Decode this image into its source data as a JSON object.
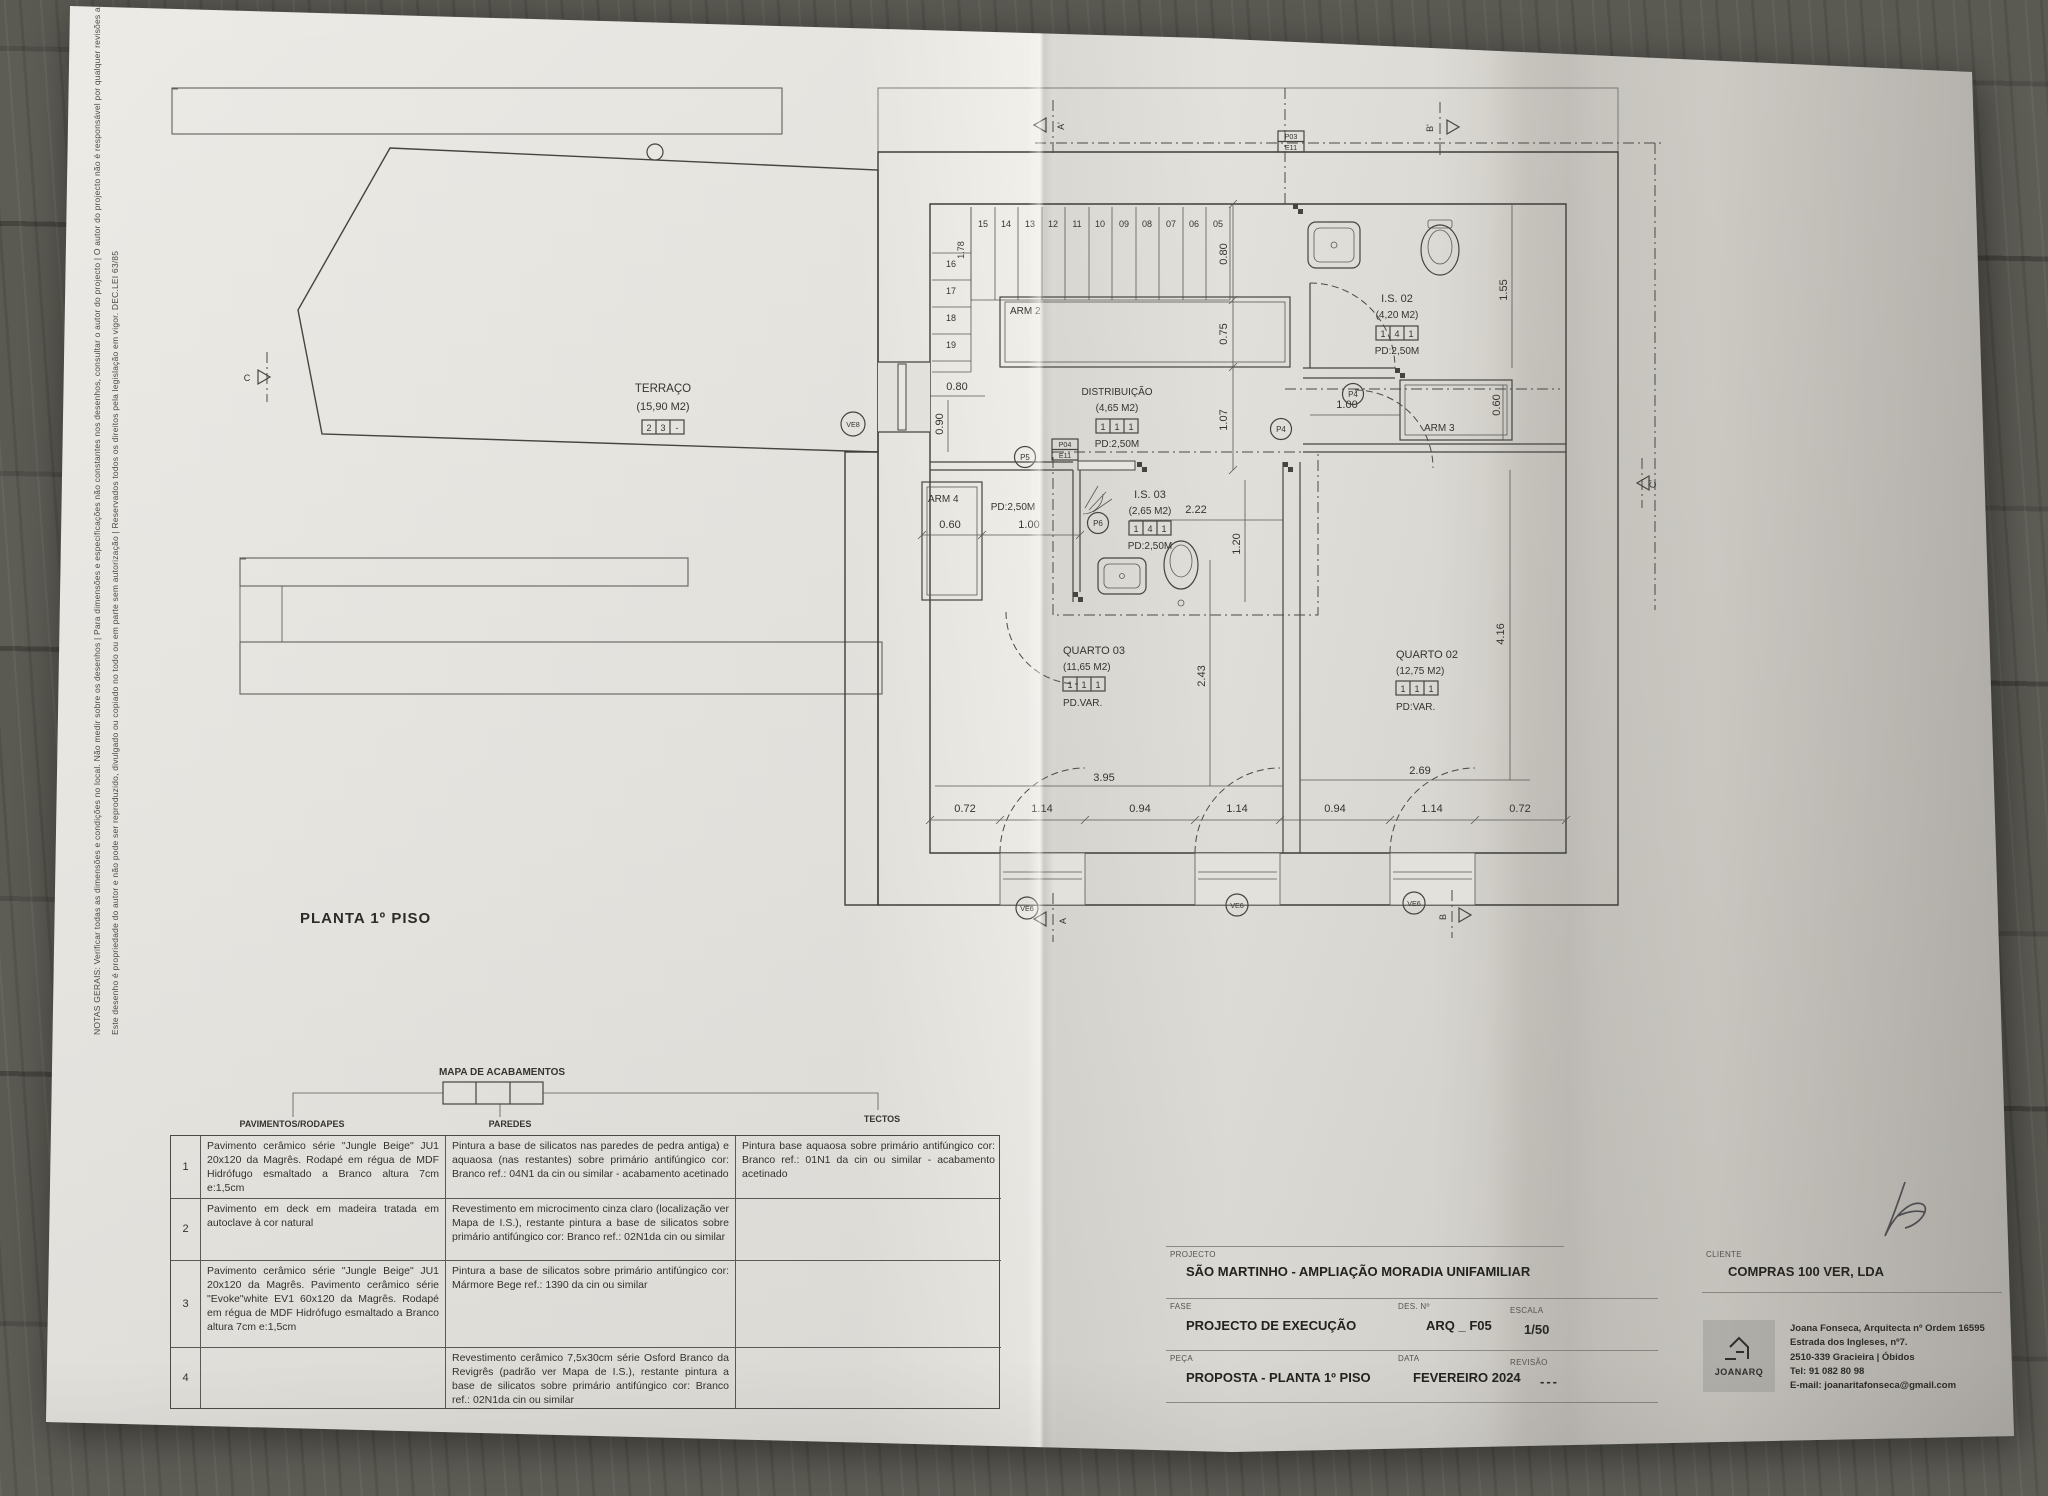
{
  "notes": {
    "line1": "NOTAS GERAIS: Verificar todas as dimensões e condições no local. Não medir sobre os desenhos | Para dimensões e especificações não constantes nos desenhos, consultar o autor do projecto | O autor do projecto não é responsável por qualquer revisões ao projecto original.",
    "line2": "Este desenho é propriedade do autor e não pode ser reproduzido, divulgado ou copiado no todo ou em parte sem autorização | Reservados todos os direitos pela legislação em vigor. DEC.LEI 63/85"
  },
  "plan": {
    "title": "PLANTA 1º PISO",
    "rooms": {
      "terraco": {
        "name": "TERRAÇO",
        "area": "(15,90 M2)",
        "finish": [
          "2",
          "3",
          "-"
        ]
      },
      "distribuicao": {
        "name": "DISTRIBUIÇÃO",
        "area": "(4,65 M2)",
        "finish": [
          "1",
          "1",
          "1"
        ],
        "pd": "PD:2,50M"
      },
      "is02": {
        "name": "I.S. 02",
        "area": "(4,20 M2)",
        "finish": [
          "1",
          "4",
          "1"
        ],
        "pd": "PD:2,50M"
      },
      "is03": {
        "name": "I.S. 03",
        "area": "(2,65 M2)",
        "finish": [
          "1",
          "4",
          "1"
        ],
        "pd": "PD:2,50M"
      },
      "quarto03": {
        "name": "QUARTO 03",
        "area": "(11,65 M2)",
        "finish": [
          "1",
          "1",
          "1"
        ],
        "pd": "PD.VAR."
      },
      "quarto02": {
        "name": "QUARTO 02",
        "area": "(12,75 M2)",
        "finish": [
          "1",
          "1",
          "1"
        ],
        "pd": "PD:VAR."
      }
    },
    "closets": {
      "arm2": "ARM 2",
      "arm3": "ARM 3",
      "arm4": "ARM 4"
    },
    "corridor_pd": "PD:2,50M",
    "stairs": {
      "top": [
        "15",
        "14",
        "13",
        "12",
        "11",
        "10",
        "09",
        "08",
        "07",
        "06",
        "05"
      ],
      "left": [
        "16",
        "17",
        "18",
        "19"
      ],
      "height": "1.78"
    },
    "dims": {
      "stair_run": "0.80",
      "arm2_depth": "0.75",
      "corridor_width": "1.07",
      "terrace_door_w": "0.80",
      "terrace_door_h": "0.90",
      "is02_door": "1.00",
      "is02_depth": "1.55",
      "arm3_depth": "0.60",
      "is03_length": "2.22",
      "is03_width": "1.20",
      "arm4_width": "0.60",
      "arm4_offset": "1.00",
      "q03_width": "2.43",
      "q03_length": "3.95",
      "q02_length": "2.69",
      "q02_height": "4.16",
      "bottom": [
        "0.72",
        "1.14",
        "0.94",
        "1.14",
        "0.94",
        "1.14",
        "0.72"
      ]
    },
    "tags": {
      "ve8": "VE8",
      "ve6": "VE6",
      "p4": "P4",
      "p5": "P5",
      "p6": "P6",
      "p04": "P04",
      "e11": "E11",
      "p03": "P03"
    },
    "markers": {
      "a_top": "A'",
      "b_top": "B'",
      "a_bottom": "A",
      "b_bottom": "B",
      "c_left": "C",
      "c_right": "C'"
    }
  },
  "finish_map": {
    "title": "MAPA DE ACABAMENTOS",
    "columns": [
      "PAVIMENTOS/RODAPES",
      "PAREDES",
      "TECTOS"
    ],
    "rows": [
      {
        "num": "1",
        "pavimentos": "Pavimento cerâmico série \"Jungle Beige\" JU1 20x120 da Magrês. Rodapé em régua de MDF Hidrófugo esmaltado a Branco altura 7cm e:1,5cm",
        "paredes": "Pintura a base de silicatos nas paredes de pedra antiga) e aquaosa (nas restantes) sobre primário antifúngico cor: Branco ref.: 04N1 da cin ou similar - acabamento acetinado",
        "tectos": "Pintura base aquaosa sobre primário antifúngico cor: Branco ref.: 01N1 da cin ou similar - acabamento acetinado"
      },
      {
        "num": "2",
        "pavimentos": "Pavimento em deck em madeira tratada em autoclave à cor natural",
        "paredes": "Revestimento em microcimento cinza claro (localização ver Mapa de I.S.), restante pintura a base de silicatos sobre primário antifúngico cor: Branco ref.: 02N1da cin ou similar",
        "tectos": ""
      },
      {
        "num": "3",
        "pavimentos": "Pavimento cerâmico série \"Jungle Beige\" JU1 20x120 da Magrês. Pavimento cerâmico série \"Evoke\"white EV1 60x120 da Magrês. Rodapé em régua de MDF Hidrófugo esmaltado a Branco altura 7cm e:1,5cm",
        "paredes": "Pintura a base de silicatos sobre primário antifúngico cor: Mármore Bege ref.: 1390 da cin ou similar",
        "tectos": ""
      },
      {
        "num": "4",
        "pavimentos": "",
        "paredes": "Revestimento cerâmico 7,5x30cm série Osford Branco da Revigrês (padrão ver Mapa de I.S.), restante pintura a base de silicatos sobre primário antifúngico cor: Branco ref.: 02N1da cin ou similar",
        "tectos": ""
      }
    ]
  },
  "title_block": {
    "projecto_label": "PROJECTO",
    "projecto": "SÃO MARTINHO - AMPLIAÇÃO MORADIA UNIFAMILIAR",
    "fase_label": "FASE",
    "fase": "PROJECTO DE EXECUÇÃO",
    "des_label": "DES. Nº",
    "des": "ARQ _ F05",
    "escala_label": "ESCALA",
    "escala": "1/50",
    "peca_label": "PEÇA",
    "peca": "PROPOSTA - PLANTA 1º PISO",
    "data_label": "DATA",
    "data": "FEVEREIRO 2024",
    "revisao_label": "REVISÃO",
    "revisao": "---",
    "cliente_label": "CLIENTE",
    "cliente": "COMPRAS 100 VER, LDA",
    "logo": "JOANARQ",
    "architect": [
      "Joana Fonseca, Arquitecta nº Ordem 16595",
      "Estrada dos Ingleses, nº7.",
      "2510-339 Gracieira | Óbidos",
      "Tel: 91 082 80 98",
      "E-mail: joanaritafonseca@gmail.com"
    ]
  }
}
